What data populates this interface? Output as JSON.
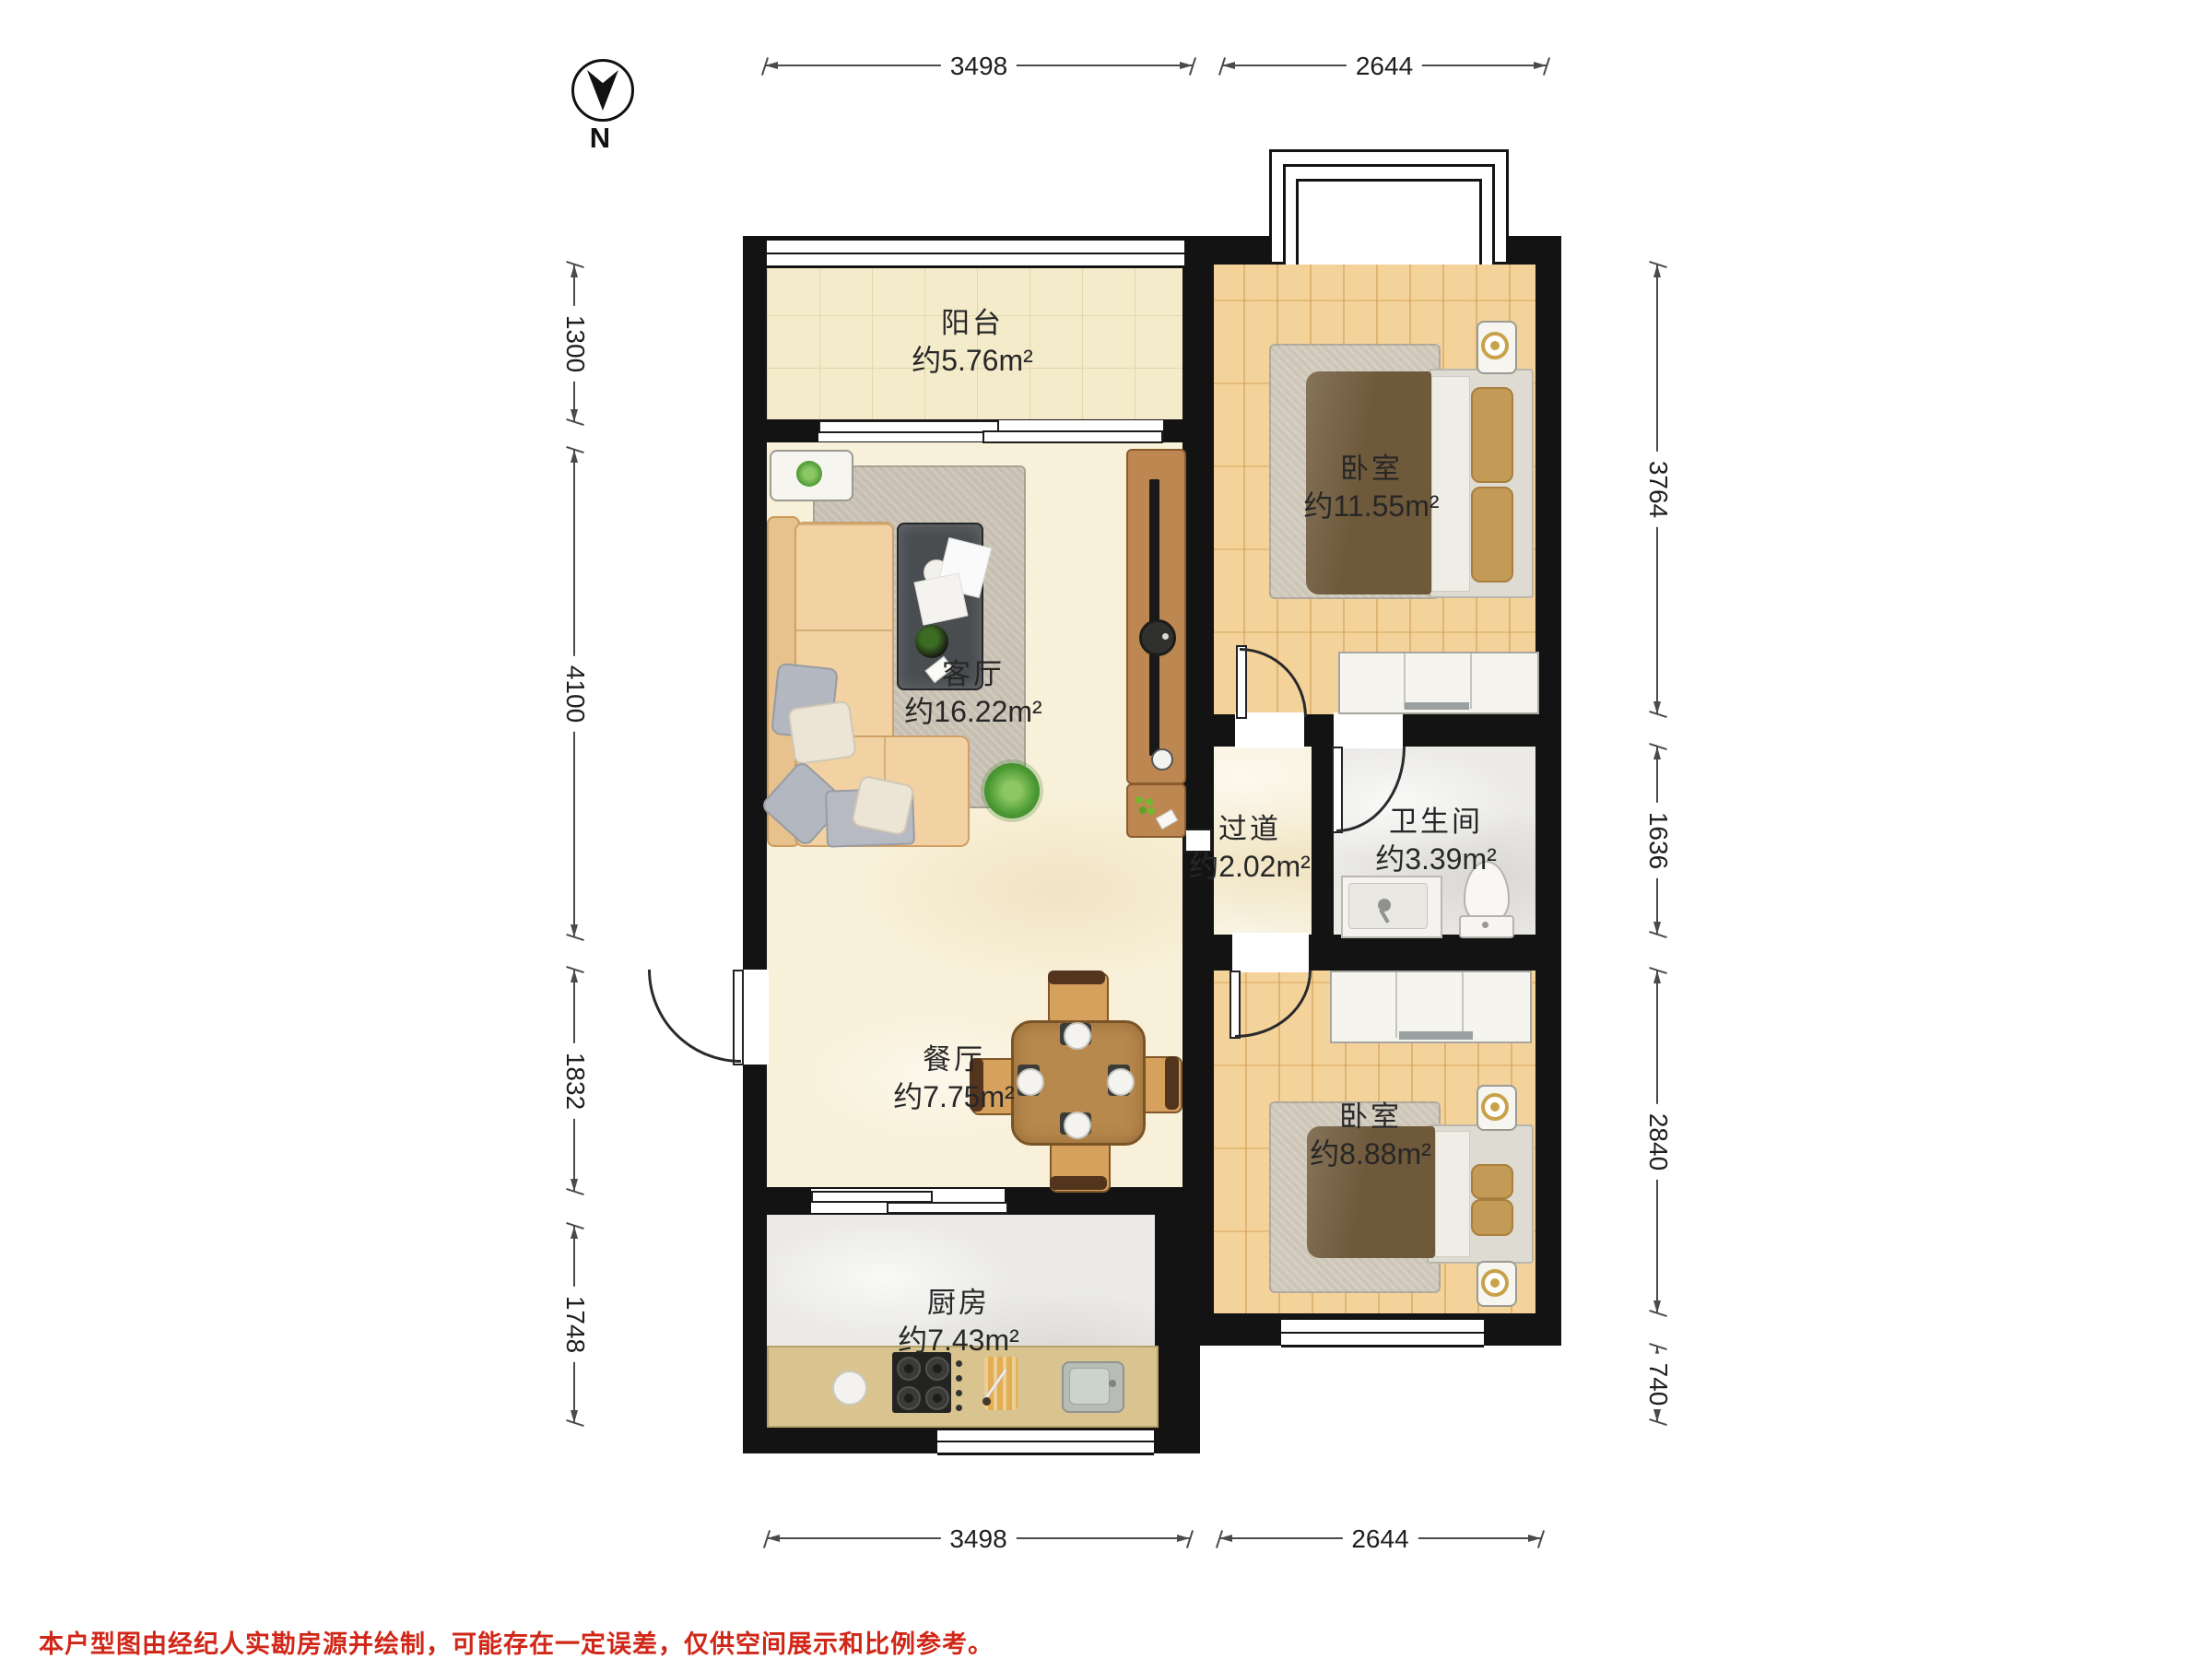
{
  "compass": {
    "label": "N"
  },
  "rooms": {
    "balcony": {
      "name": "阳台",
      "area": "约5.76m²"
    },
    "bedroom_top": {
      "name": "卧室",
      "area": "约11.55m²"
    },
    "living": {
      "name": "客厅",
      "area": "约16.22m²"
    },
    "hallway": {
      "name": "过道",
      "area": "约2.02m²"
    },
    "bathroom": {
      "name": "卫生间",
      "area": "约3.39m²"
    },
    "dining": {
      "name": "餐厅",
      "area": "约7.75m²"
    },
    "bedroom_bottom": {
      "name": "卧室",
      "area": "约8.88m²"
    },
    "kitchen": {
      "name": "厨房",
      "area": "约7.43m²"
    }
  },
  "dimensions": {
    "top": [
      "3498",
      "2644"
    ],
    "bottom": [
      "3498",
      "2644"
    ],
    "left": [
      "1300",
      "4100",
      "1832",
      "1748"
    ],
    "right": [
      "3764",
      "1636",
      "2840",
      "740"
    ]
  },
  "disclaimer": "本户型图由经纪人实勘房源并绘制，可能存在一定误差，仅供空间展示和比例参考。",
  "colors": {
    "wall": "#131313",
    "dim": "#4a4a4a",
    "red": "#d02718",
    "floor-cream": "#f8f0d8",
    "floor-tile": "#f3ebca",
    "floor-wood": "#f2cd8d",
    "floor-gray": "#ebeae7",
    "counter": "#d9c48f",
    "sofa": "#f2d2a2",
    "table-wood": "#b8894d",
    "tv-wood": "#bc8751",
    "bed-blanket": "#6e593a",
    "pillow-tan": "#c49b56",
    "plant-green": "#4c9a33"
  }
}
